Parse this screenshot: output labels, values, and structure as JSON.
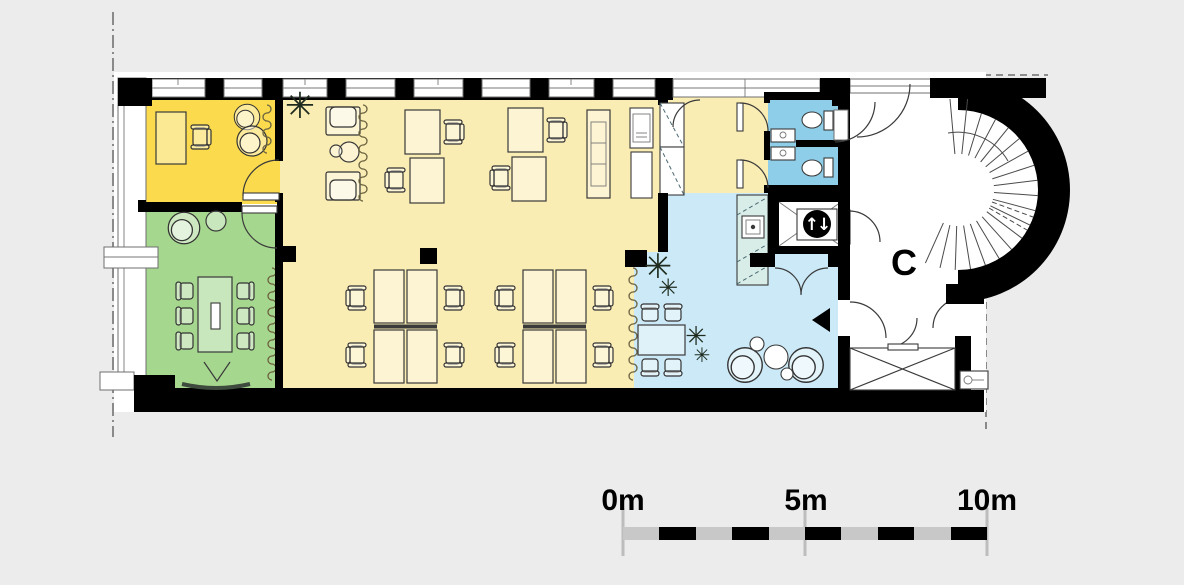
{
  "colors": {
    "page_bg": "#ECECEC",
    "wall": "#000000",
    "office_yellow": "#FBDB4D",
    "open_space_yellow": "#FAEDB4",
    "meeting_green": "#A6D78F",
    "wc_blue": "#8FCEE8",
    "lounge_blue": "#CBE9F6",
    "counter_teal": "#D8ECE8",
    "scale_bar_gray": "#C8C8C8",
    "tick_gray": "#BDBDBD"
  },
  "labels": {
    "stair_hall": "C"
  },
  "elevator": {
    "arrows": "↑↓"
  },
  "plants": {
    "glyph": "✳"
  },
  "scale_bar": {
    "tick_labels": [
      "0m",
      "5m",
      "10m"
    ]
  }
}
